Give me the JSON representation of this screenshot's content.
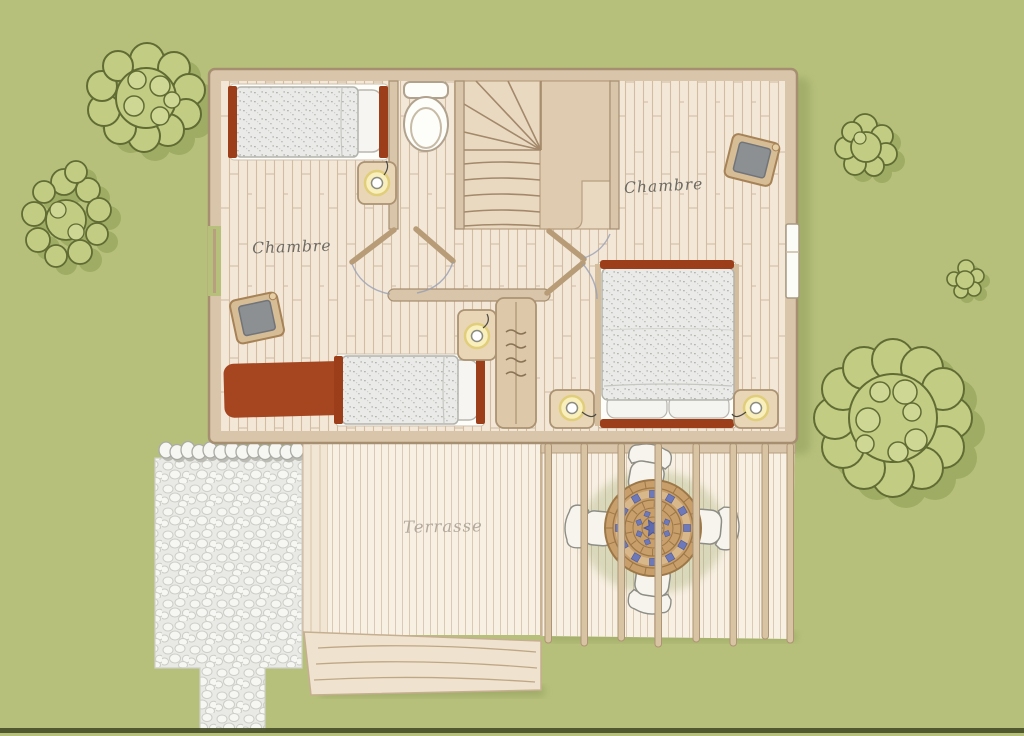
{
  "scene": {
    "description": "Hand-drawn floor plan of a house upper floor with two bedrooms, a staircase, a terrace with pergola, garden trees and a gravel path",
    "floor_labels": {
      "bedroom_left": "Chambre",
      "bedroom_right": "Chambre",
      "terrace": "Terrasse"
    },
    "objects": {
      "beds_single": 2,
      "beds_double": 1,
      "nightstands_with_lamps": 4,
      "toilet": 1,
      "staircase": 1,
      "roof_windows": 2,
      "wardrobe": 1,
      "rug": 1,
      "terrace_table": 1,
      "terrace_chairs": 4,
      "pergola_beams": 8,
      "trees": 5,
      "gravel_area": 1
    }
  },
  "colors": {
    "background": "#b6c07b",
    "tree_fill": "#c3cc83",
    "tree_inner": "#cfd794",
    "tree_outline": "#606c34",
    "tree_shadow": "#9cab61",
    "shadow": "#8d9b59",
    "wall": "#d9c5a9",
    "wall_outline": "#a68e71",
    "floor": "#f3e7d7",
    "terrace_floor": "#f8f0e3",
    "terrace_border": "#efe2cf",
    "stair_tread": "#e9d9c1",
    "stair_landing": "#dfccb0",
    "bed_frame": "#9d3e1b",
    "rug": "#a54621",
    "duvet": "#eaeae8",
    "sheet": "#fdfdfa",
    "nightstand": "#e9d6b6",
    "lamp_glow": "#f8efbc",
    "lamp_ring": "#e0ce7a",
    "skylight_frame": "#d7bd96",
    "skylight_glass": "#8c9093",
    "cabinet": "#ddc9a9",
    "table_top": "#c89e6b",
    "table_line": "#9c7848",
    "table_tile": "#6d79b8",
    "chair": "#f7f4ee",
    "chair_outline": "#8d8d86",
    "gravel": "#e9e9e5",
    "pebble": "#f6f6f3",
    "beam": "#d8c3a2",
    "beam_outline": "#ae9476",
    "door": "#c2a47f",
    "door_arc": "#98a0b5",
    "window_white": "#fbfbf8",
    "label_ink": "#6d6a62",
    "terrace_label_ink": "#b3a99c",
    "ground_line": "#454d28"
  }
}
